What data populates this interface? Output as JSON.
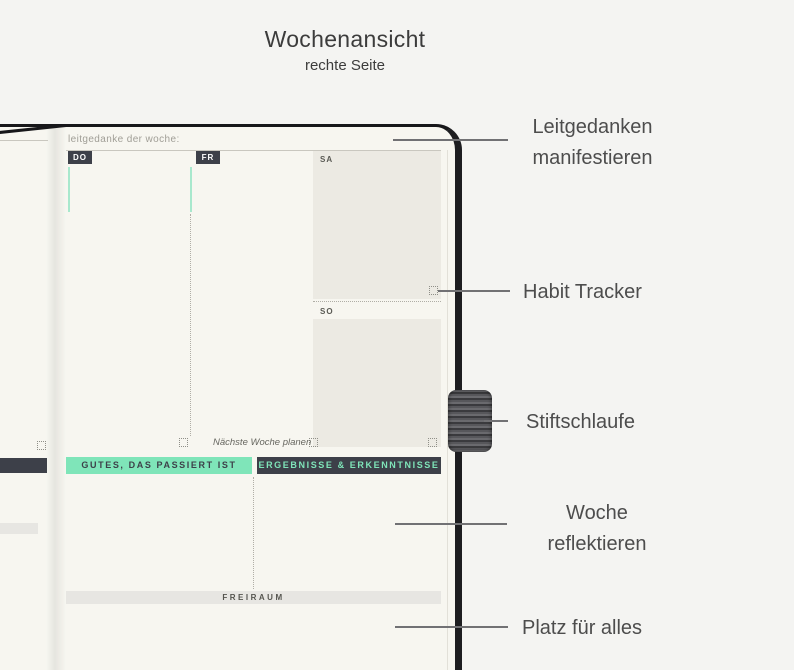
{
  "title": {
    "heading": "Wochenansicht",
    "subheading": "rechte Seite"
  },
  "planner_page": {
    "header_label": "leitgedanke der woche:",
    "days": [
      {
        "label": "DO"
      },
      {
        "label": "FR"
      },
      {
        "label": "SA"
      },
      {
        "label": "SO"
      }
    ],
    "next_week_label": "Nächste Woche planen",
    "banners": {
      "good": "GUTES, DAS PASSIERT IST",
      "results": "ERGEBNISSE & ERKENNTNISSE",
      "free_space": "FREIRAUM"
    }
  },
  "callouts": [
    {
      "label": "Leitgedanken manifestieren"
    },
    {
      "label": "Habit Tracker"
    },
    {
      "label": "Stiftschlaufe"
    },
    {
      "label": "Woche reflektieren"
    },
    {
      "label": "Platz für alles"
    }
  ],
  "colors": {
    "accent_mint": "#7fe5b9",
    "dark_slate": "#3d4049",
    "page_cream": "#f7f6f0",
    "block_gray": "#eceae3",
    "background": "#f4f4f2"
  }
}
